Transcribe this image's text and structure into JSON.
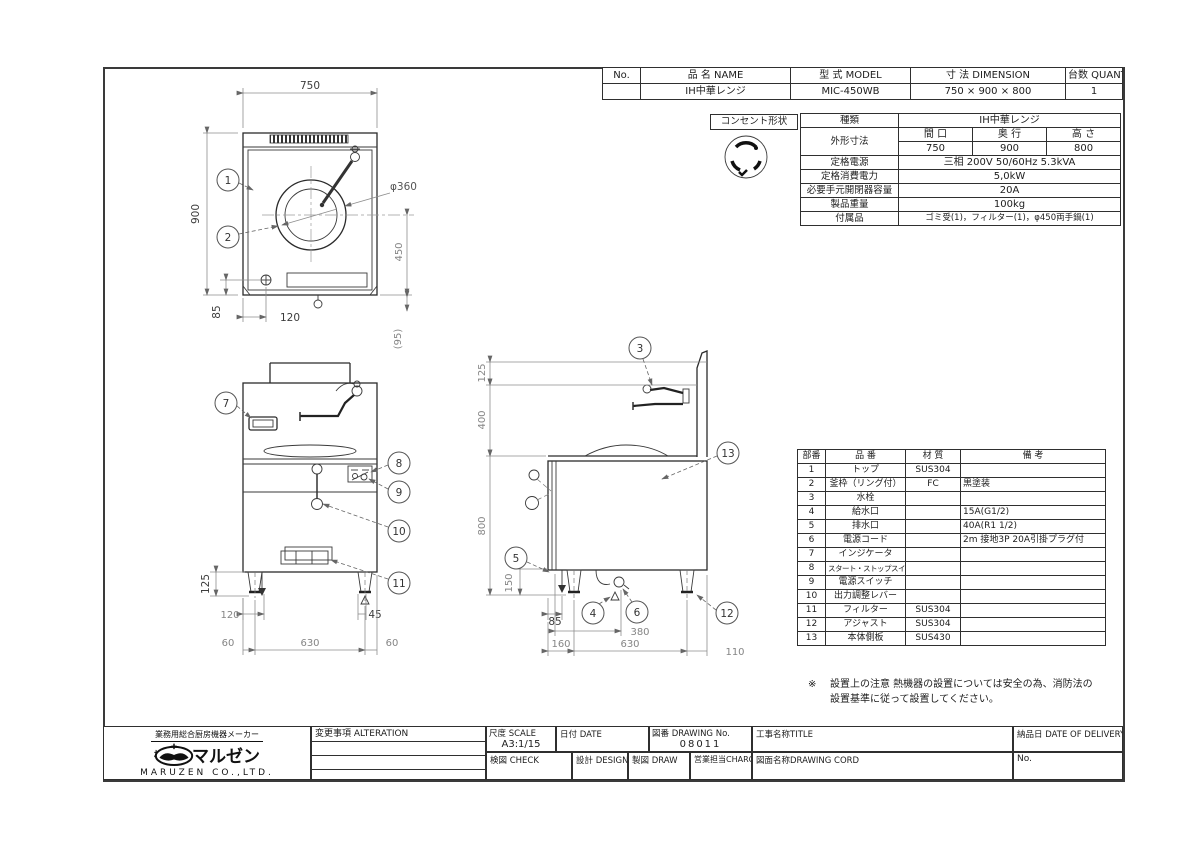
{
  "header_table": {
    "no_label": "No.",
    "name_label": "品 名 NAME",
    "model_label": "型 式 MODEL",
    "dim_label": "寸 法 DIMENSION",
    "qty_label": "台数 QUANTITY",
    "no": "",
    "name": "IH中華レンジ",
    "model": "MIC-450WB",
    "dimension": "750 × 900 × 800",
    "quantity": "1"
  },
  "outlet": {
    "label": "コンセント形状",
    "icon": "twist-lock-receptacle-icon"
  },
  "spec_table": {
    "type_label": "種類",
    "type_value": "IH中華レンジ",
    "size_label": "外形寸法",
    "col_w": "間 口",
    "col_d": "奥 行",
    "col_h": "高 さ",
    "w": "750",
    "d": "900",
    "h": "800",
    "power_label": "定格電源",
    "power_value": "三相 200V 50/60Hz 5.3kVA",
    "consumption_label": "定格消費電力",
    "consumption_value": "5,0kW",
    "breaker_label": "必要手元開閉器容量",
    "breaker_value": "20A",
    "weight_label": "製品重量",
    "weight_value": "100kg",
    "accessories_label": "付属品",
    "accessories_value": "ゴミ受(1)，フィルター(1)，φ450両手鍋(1)"
  },
  "parts_table": {
    "h_no": "部番",
    "h_name": "品 番",
    "h_material": "材 質",
    "h_note": "備 考",
    "rows": [
      {
        "no": "1",
        "name": "トップ",
        "material": "SUS304",
        "note": ""
      },
      {
        "no": "2",
        "name": "釜枠（リング付）",
        "material": "FC",
        "note": "黒塗装"
      },
      {
        "no": "3",
        "name": "水栓",
        "material": "",
        "note": ""
      },
      {
        "no": "4",
        "name": "給水口",
        "material": "",
        "note": "15A(G1/2)"
      },
      {
        "no": "5",
        "name": "排水口",
        "material": "",
        "note": "40A(R1 1/2)"
      },
      {
        "no": "6",
        "name": "電源コード",
        "material": "",
        "note": "2m 接地3P 20A引掛プラグ付"
      },
      {
        "no": "7",
        "name": "インジケータ",
        "material": "",
        "note": ""
      },
      {
        "no": "8",
        "name": "スタート・ストップスイッチ",
        "material": "",
        "note": ""
      },
      {
        "no": "9",
        "name": "電源スイッチ",
        "material": "",
        "note": ""
      },
      {
        "no": "10",
        "name": "出力調整レバー",
        "material": "",
        "note": ""
      },
      {
        "no": "11",
        "name": "フィルター",
        "material": "SUS304",
        "note": ""
      },
      {
        "no": "12",
        "name": "アジャスト",
        "material": "SUS304",
        "note": ""
      },
      {
        "no": "13",
        "name": "本体側板",
        "material": "SUS430",
        "note": ""
      }
    ]
  },
  "note": {
    "mark": "※",
    "line1": "設置上の注意  熱機器の設置については安全の為、消防法の",
    "line2": "設置基準に従って設置してください。"
  },
  "title_block": {
    "alteration": "変更事項  ALTERATION",
    "scale_label": "尺度 SCALE",
    "scale_value": "A3:1/15",
    "date_label": "日付 DATE",
    "drawing_no_label": "図番 DRAWING No.",
    "drawing_no_value": "08011",
    "title_label": "工事名称TITLE",
    "delivery_label": "納品日  DATE OF DELIVERY",
    "check_label": "検図 CHECK",
    "design_label": "設計 DESIGN",
    "draw_label": "製図 DRAW",
    "charge_label": "営業担当CHARGE",
    "drawing_cord_label": "図面名称DRAWING CORD",
    "no_label": "No."
  },
  "maker": {
    "tagline": "業務用総合厨房機器メーカー",
    "company_prefix": "株式会社",
    "company_name": "マルゼン",
    "company_en": "MARUZEN CO.,LTD."
  },
  "plan_view": {
    "dims": {
      "w750": "750",
      "d900": "900",
      "dia": "φ360",
      "d450": "450",
      "d85": "85",
      "d120": "120",
      "d95": "(95)"
    },
    "callouts": [
      "1",
      "2"
    ]
  },
  "front_view": {
    "dims": {
      "d125": "125",
      "d120": "120",
      "d45": "45",
      "d60l": "60",
      "d630": "630",
      "d60r": "60"
    },
    "callouts": [
      "7",
      "8",
      "9",
      "10",
      "11"
    ]
  },
  "side_view": {
    "dims": {
      "d125": "125",
      "d400": "400",
      "d800": "800",
      "d150": "150",
      "d85": "85",
      "d380": "380",
      "d160": "160",
      "d630": "630",
      "d110": "110"
    },
    "callouts": [
      "3",
      "13",
      "5",
      "4",
      "6",
      "12"
    ]
  },
  "colors": {
    "line": "#2b2b2b",
    "dim_text": "#858585",
    "table_line": "#2f2f2f"
  }
}
